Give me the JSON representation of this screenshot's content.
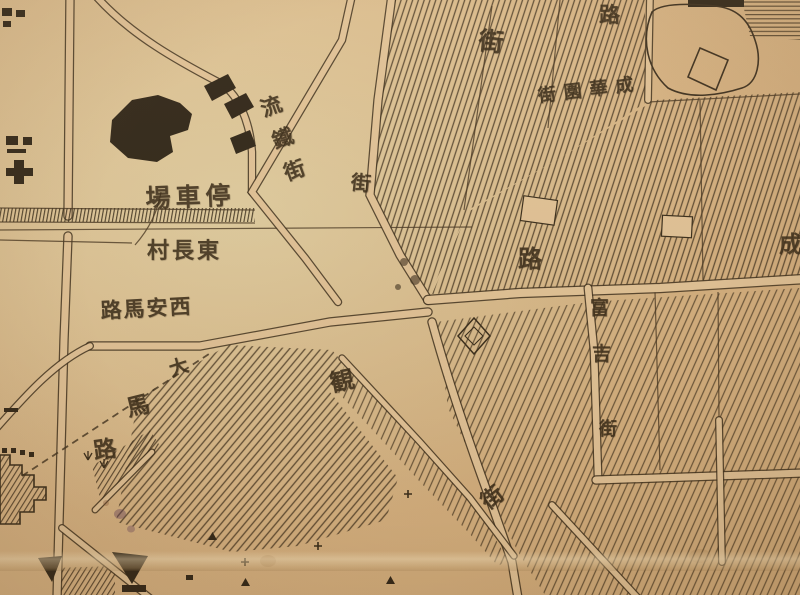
{
  "colors": {
    "paper": "#d7b585",
    "paper_light": "#e0c195",
    "ink": "#392c1b",
    "hatch": "#46341f",
    "stain_purple": "#5e3a5a"
  },
  "labels": {
    "station": {
      "text": "場車停"
    },
    "village": {
      "text": "村長東"
    },
    "xian_road": {
      "text": "路馬安西"
    },
    "grand_road_char1": {
      "text": "大"
    },
    "grand_road_char2": {
      "text": "馬"
    },
    "grand_road_char3": {
      "text": "路"
    },
    "northwest_street": {
      "text": "流鐵街"
    },
    "street_char_mid": {
      "text": "街"
    },
    "street_char_top": {
      "text": "街"
    },
    "road_char_topright": {
      "text": "路"
    },
    "garden_street": {
      "text": "街園華成"
    },
    "road_char_center": {
      "text": "路"
    },
    "right_street_char1": {
      "text": "富"
    },
    "right_street_char2": {
      "text": "吉"
    },
    "right_street_char3": {
      "text": "街"
    },
    "guan_char": {
      "text": "観"
    },
    "street_char_diag": {
      "text": "街"
    },
    "cheng_char_edge": {
      "text": "成"
    }
  }
}
